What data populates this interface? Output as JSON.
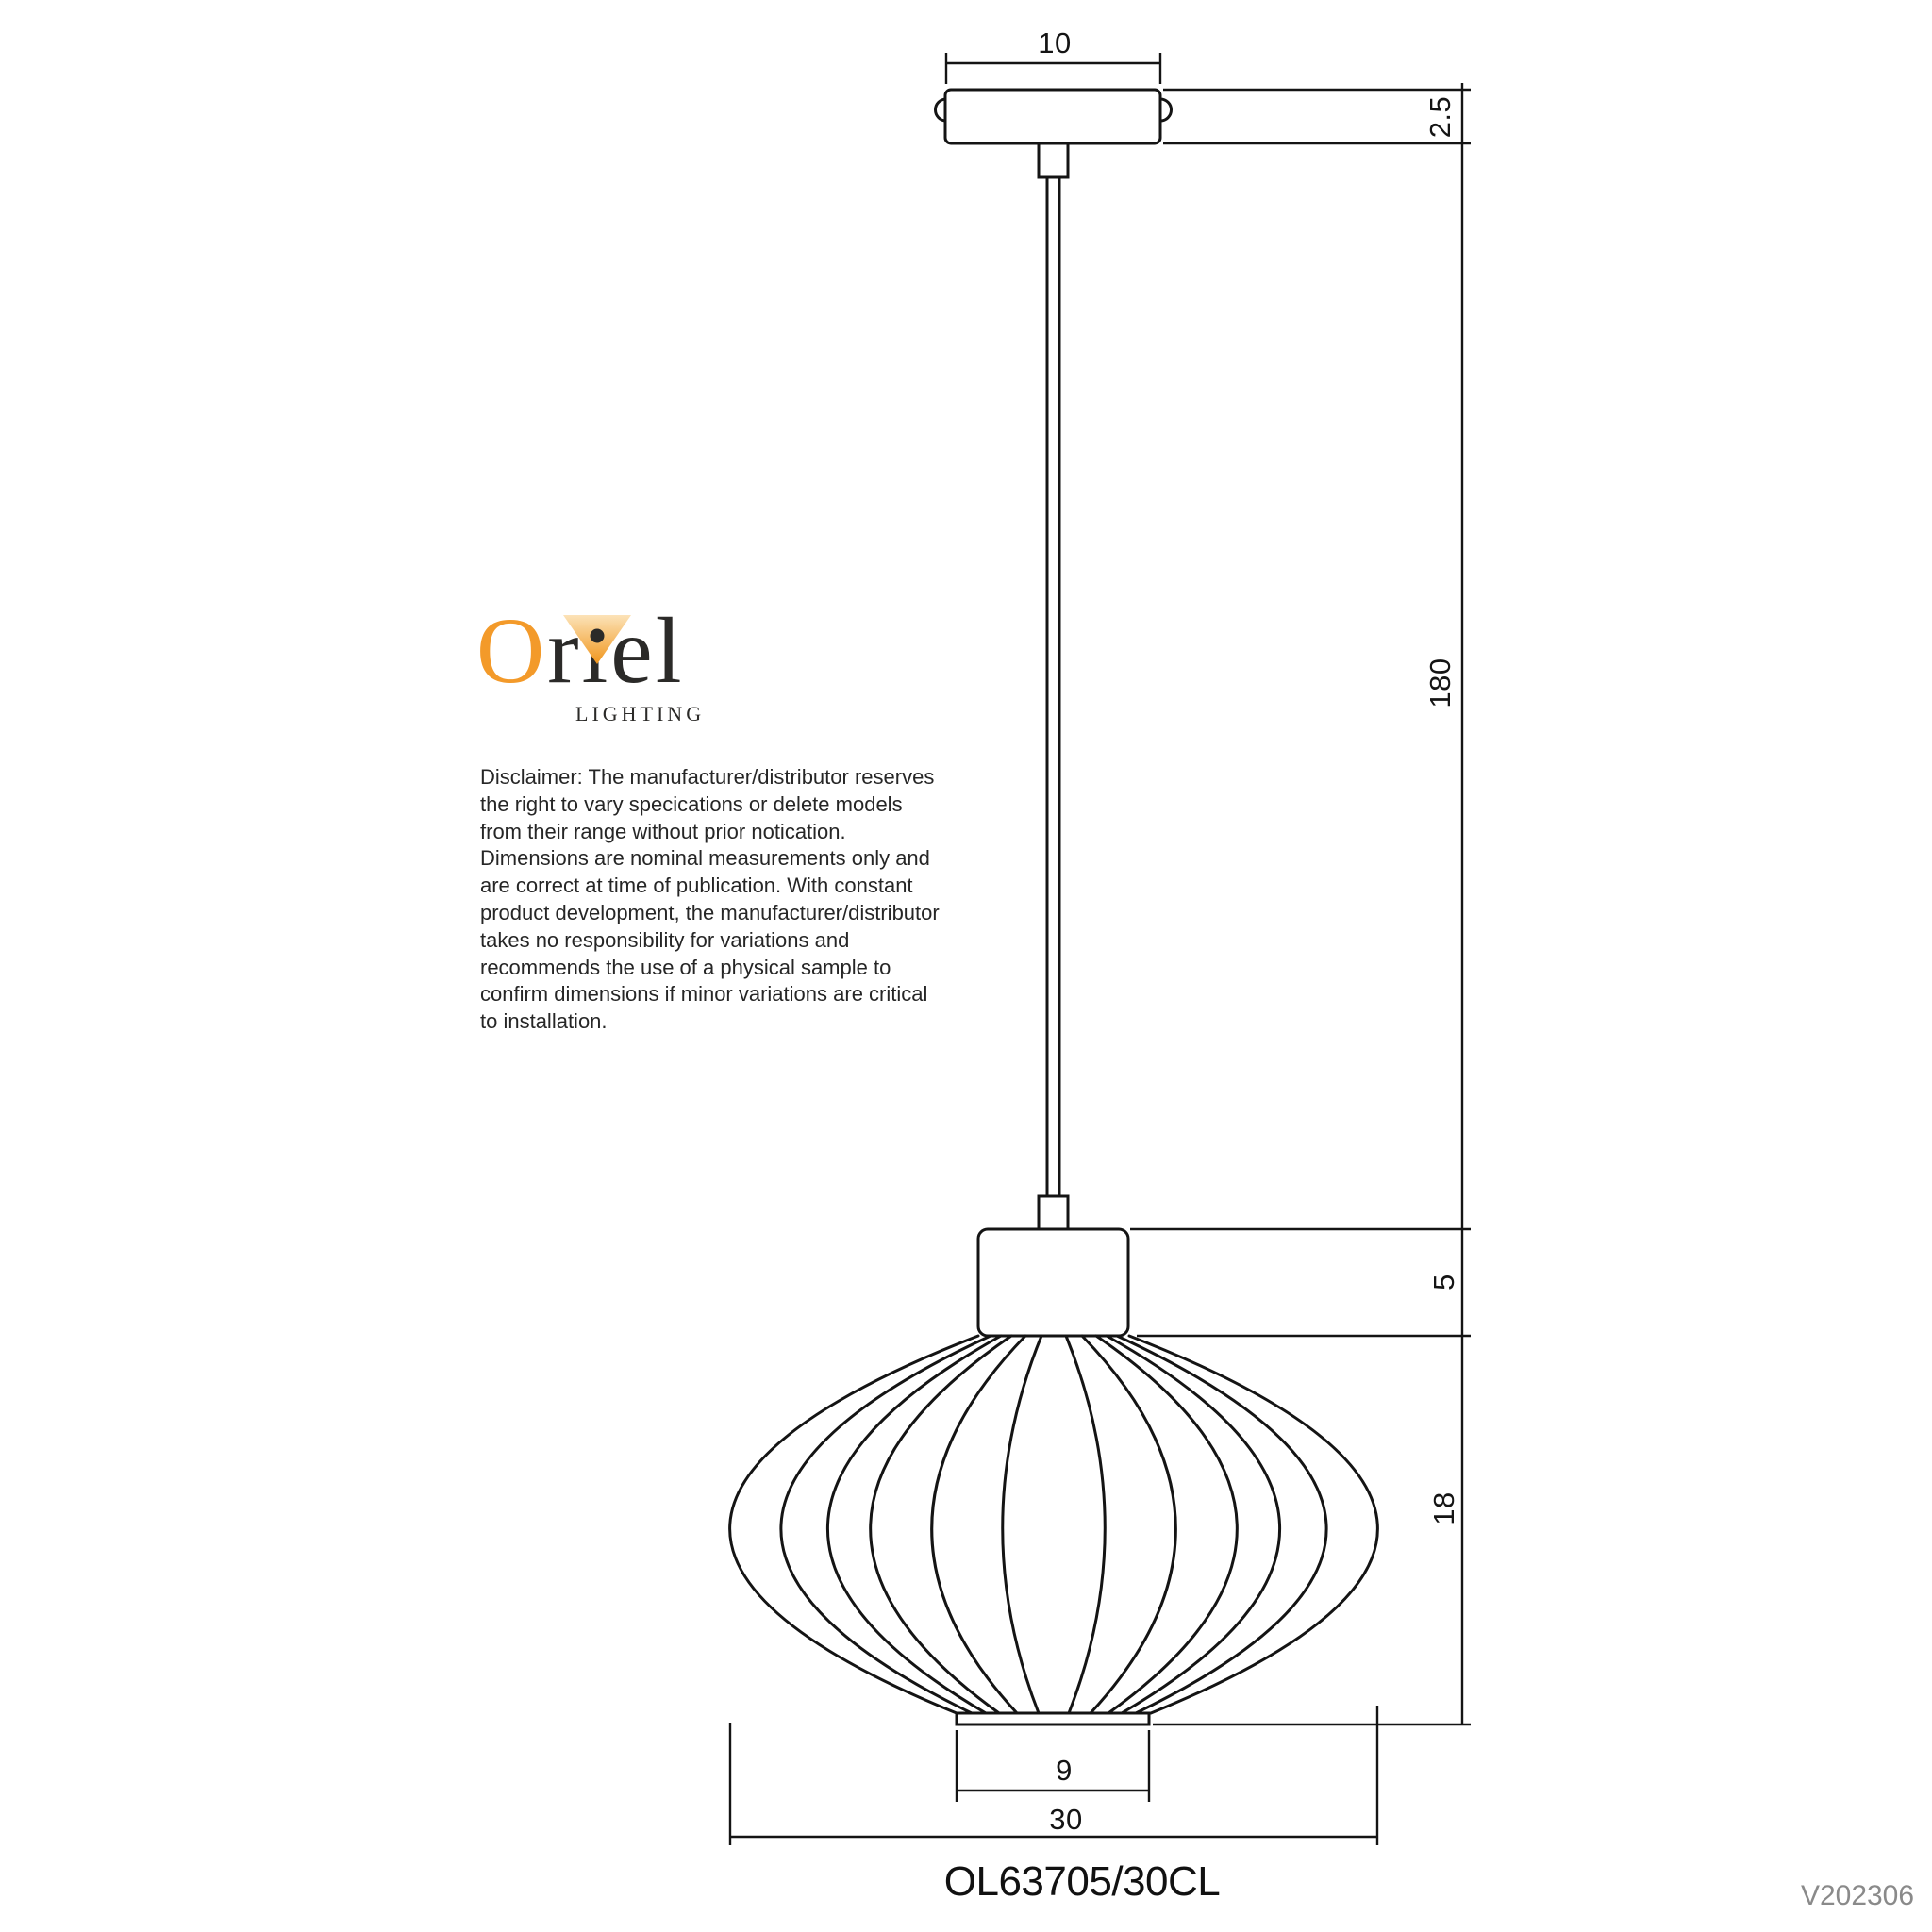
{
  "logo": {
    "brand_o": "O",
    "brand_rest": "riel",
    "subtitle": "LIGHTING"
  },
  "disclaimer": "Disclaimer: The manufacturer/distributor reserves\nthe right to vary specications or delete models\nfrom their range without prior notication.\nDimensions are nominal measurements only and\nare correct at time of publication. With constant\nproduct development, the manufacturer/distributor\ntakes no responsibility for variations and\nrecommends the use of a physical sample to\nconfirm dimensions if minor variations are critical\nto installation.",
  "dimensions": {
    "canopy_width_cm": "10",
    "canopy_height_cm": "2.5",
    "suspension_length_cm": "180",
    "gallery_height_cm": "5",
    "shade_height_cm": "18",
    "shade_bottom_diameter_cm": "9",
    "shade_diameter_cm": "30"
  },
  "product": {
    "code": "OL63705/30CL",
    "version": "V202306"
  },
  "colors": {
    "line": "#141414",
    "logo_orange": "#f39a2a",
    "logo_dark": "#2b2a28",
    "version_gray": "#8a8a8a"
  }
}
